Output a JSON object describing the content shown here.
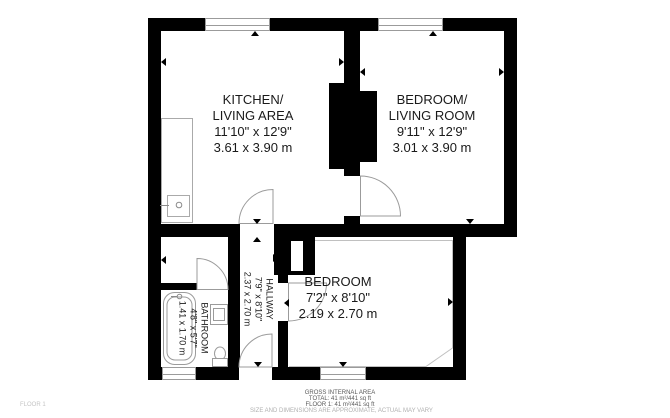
{
  "rooms": {
    "kitchen_living": {
      "name_line1": "KITCHEN/",
      "name_line2": "LIVING AREA",
      "size_imperial": "11'10\" x 12'9\"",
      "size_metric": "3.61 x 3.90 m"
    },
    "bedroom_living": {
      "name_line1": "BEDROOM/",
      "name_line2": "LIVING ROOM",
      "size_imperial": "9'11\" x 12'9\"",
      "size_metric": "3.01 x 3.90 m"
    },
    "bedroom": {
      "name": "BEDROOM",
      "size_imperial": "7'2\" x 8'10\"",
      "size_metric": "2.19 x 2.70 m"
    },
    "hallway": {
      "name": "HALLWAY",
      "size_imperial": "7'9\" x 8'10\"",
      "size_metric": "2.37 x 2.70 m"
    },
    "bathroom": {
      "name": "BATHROOM",
      "size_imperial": "4'8\" x 5'7\"",
      "size_metric": "1.41 x 1.70 m"
    }
  },
  "footer": {
    "heading": "GROSS INTERNAL AREA",
    "total": "TOTAL: 41 m²/441 sq ft",
    "floor1": "FLOOR 1: 41 m²/441 sq ft",
    "disclaimer": "SIZE AND DIMENSIONS ARE APPROXIMATE, ACTUAL MAY VARY"
  },
  "floor_label": "FLOOR 1",
  "colors": {
    "wall": "#000000",
    "thin_line": "#9b9b9b",
    "label_text": "#1a1a1a",
    "footer_text": "#5a5a5a",
    "faint_text": "#b0b0b0"
  }
}
